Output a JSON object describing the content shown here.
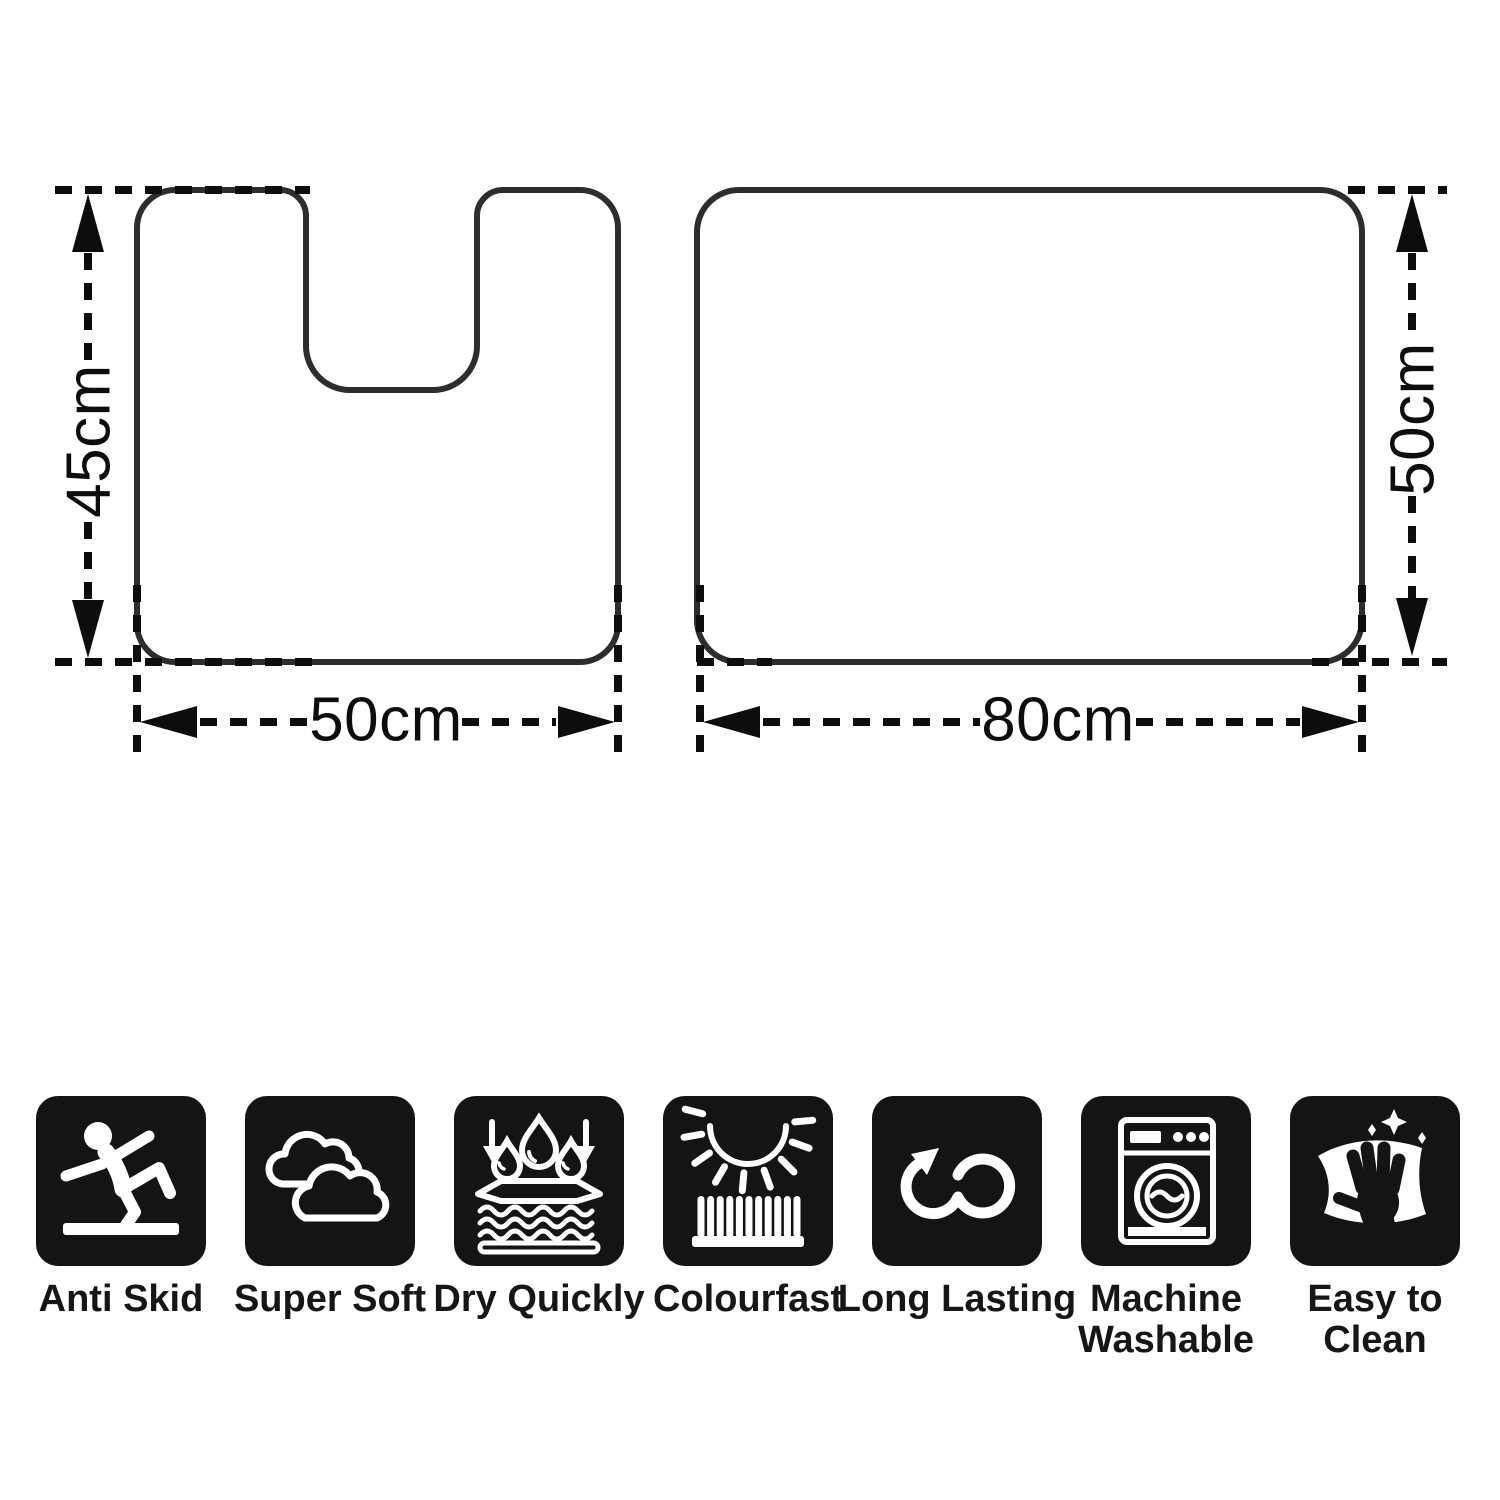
{
  "diagram": {
    "pedestal_mat": {
      "name": "pedestal mat outline with U-shaped cutout",
      "height_label": "45cm",
      "width_label": "50cm"
    },
    "bath_mat": {
      "name": "rectangular bath mat outline",
      "height_label": "50cm",
      "width_label": "80cm"
    }
  },
  "features": [
    {
      "icon": "anti-skid-icon",
      "label_lines": [
        "Anti Skid"
      ]
    },
    {
      "icon": "super-soft-icon",
      "label_lines": [
        "Super Soft"
      ]
    },
    {
      "icon": "dry-quickly-icon",
      "label_lines": [
        "Dry Quickly"
      ]
    },
    {
      "icon": "colourfast-icon",
      "label_lines": [
        "Colourfast"
      ]
    },
    {
      "icon": "long-lasting-icon",
      "label_lines": [
        "Long Lasting"
      ]
    },
    {
      "icon": "machine-washable-icon",
      "label_lines": [
        "Machine",
        "Washable"
      ]
    },
    {
      "icon": "easy-to-clean-icon",
      "label_lines": [
        "Easy to",
        "Clean"
      ]
    }
  ],
  "colors": {
    "background": "#ffffff",
    "mat_outline": "#2d2d2d",
    "dimension_line": "#0d0d0d",
    "icon_background": "#141414",
    "icon_foreground": "#ffffff"
  }
}
